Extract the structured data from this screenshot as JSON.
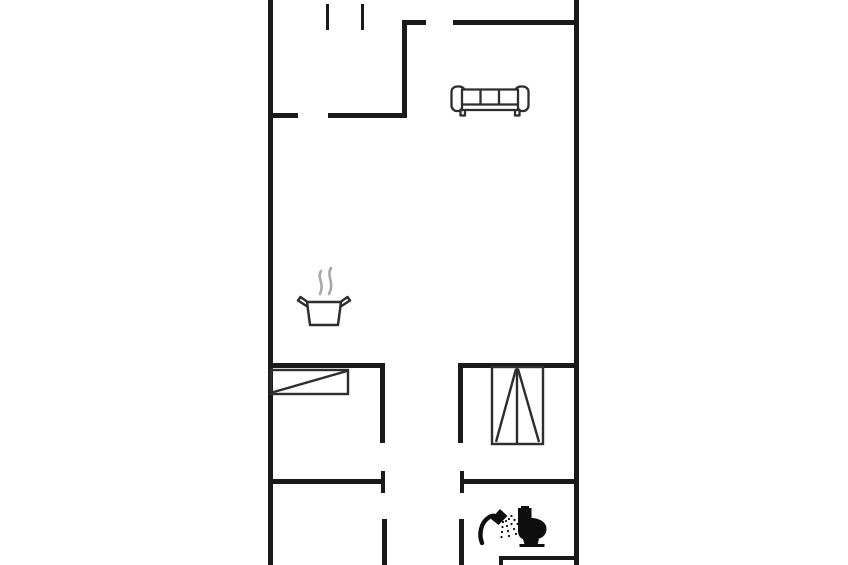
{
  "meta": {
    "type": "floor-plan",
    "background": "#ffffff"
  },
  "canvas": {
    "width": 848,
    "height": 565
  },
  "colors": {
    "wall": "#1a1a1a",
    "furniture_line": "#2e2e2e",
    "icon_black": "#0e0e0e",
    "steam": "#a8a8a8",
    "background": "#ffffff"
  },
  "walls": [
    {
      "name": "outer-wall-left",
      "x": 268,
      "y": 0,
      "w": 5,
      "h": 565
    },
    {
      "name": "outer-wall-right",
      "x": 574,
      "y": 0,
      "w": 5,
      "h": 565
    },
    {
      "name": "entry-bottom-wall-stub",
      "x": 268,
      "y": 113,
      "w": 30,
      "h": 5
    },
    {
      "name": "entry-bottom-wall",
      "x": 328,
      "y": 113,
      "w": 79,
      "h": 5
    },
    {
      "name": "entry-living-divider-wall",
      "x": 402,
      "y": 20,
      "w": 5,
      "h": 98
    },
    {
      "name": "living-top-wall-stub",
      "x": 402,
      "y": 20,
      "w": 24,
      "h": 5
    },
    {
      "name": "living-top-wall",
      "x": 453,
      "y": 20,
      "w": 126,
      "h": 5
    },
    {
      "name": "mid-divider-wall-left",
      "x": 268,
      "y": 363,
      "w": 117,
      "h": 5
    },
    {
      "name": "mid-divider-wall-right",
      "x": 458,
      "y": 363,
      "w": 121,
      "h": 5
    },
    {
      "name": "hallway-wall-left-upper",
      "x": 380,
      "y": 363,
      "w": 5,
      "h": 80
    },
    {
      "name": "hallway-wall-right-upper",
      "x": 458,
      "y": 363,
      "w": 5,
      "h": 80
    },
    {
      "name": "lower-divider-wall-left",
      "x": 268,
      "y": 479,
      "w": 114,
      "h": 5
    },
    {
      "name": "lower-divider-wall-right",
      "x": 462,
      "y": 479,
      "w": 117,
      "h": 5
    },
    {
      "name": "door-jamb-left",
      "x": 381,
      "y": 471,
      "w": 4,
      "h": 22
    },
    {
      "name": "door-jamb-right",
      "x": 460,
      "y": 471,
      "w": 4,
      "h": 22
    },
    {
      "name": "hallway-wall-left-lower",
      "x": 382,
      "y": 519,
      "w": 5,
      "h": 46
    },
    {
      "name": "hallway-wall-right-lower",
      "x": 459,
      "y": 519,
      "w": 5,
      "h": 46
    },
    {
      "name": "top-edge-tick-1",
      "x": 326,
      "y": 4,
      "w": 3,
      "h": 26
    },
    {
      "name": "top-edge-tick-2",
      "x": 361,
      "y": 4,
      "w": 3,
      "h": 26
    }
  ],
  "furniture_lines": [
    {
      "name": "wardrobe-left-body",
      "kind": "rect",
      "x": 271,
      "y": 370,
      "w": 77,
      "h": 24,
      "sw": 2.4,
      "color": "furniture_line"
    },
    {
      "name": "wardrobe-left-diagonal",
      "kind": "line",
      "x1": 272,
      "y1": 392.5,
      "x2": 347,
      "y2": 371,
      "sw": 2.4,
      "color": "furniture_line"
    },
    {
      "name": "wardrobe-right-body",
      "kind": "rect",
      "x": 492,
      "y": 367,
      "w": 51,
      "h": 77,
      "sw": 2.4,
      "color": "furniture_line"
    },
    {
      "name": "wardrobe-right-center-line",
      "kind": "line",
      "x1": 517,
      "y1": 368,
      "x2": 517,
      "y2": 443,
      "sw": 2.4,
      "color": "furniture_line"
    },
    {
      "name": "wardrobe-right-door-diagonal-1",
      "kind": "line",
      "x1": 516,
      "y1": 369,
      "x2": 496,
      "y2": 442,
      "sw": 2.4,
      "color": "furniture_line"
    },
    {
      "name": "wardrobe-right-door-diagonal-2",
      "kind": "line",
      "x1": 518,
      "y1": 369,
      "x2": 539,
      "y2": 442,
      "sw": 2.4,
      "color": "furniture_line"
    },
    {
      "name": "shower-stall-top-wall",
      "kind": "line",
      "x1": 499,
      "y1": 558,
      "x2": 577,
      "y2": 558,
      "sw": 4,
      "color": "wall"
    },
    {
      "name": "shower-stall-left-wall",
      "kind": "line",
      "x1": 501,
      "y1": 556,
      "x2": 501,
      "y2": 565,
      "sw": 4,
      "color": "wall"
    }
  ],
  "furniture": {
    "sofa": {
      "label": "sofa",
      "transform": "translate(451,84)"
    },
    "pot": {
      "label": "cooking-pot-with-steam",
      "transform": "translate(296,266)"
    },
    "shower": {
      "label": "shower",
      "transform": "translate(478,506)"
    },
    "toilet": {
      "label": "toilet",
      "transform": "translate(515,506)"
    }
  }
}
